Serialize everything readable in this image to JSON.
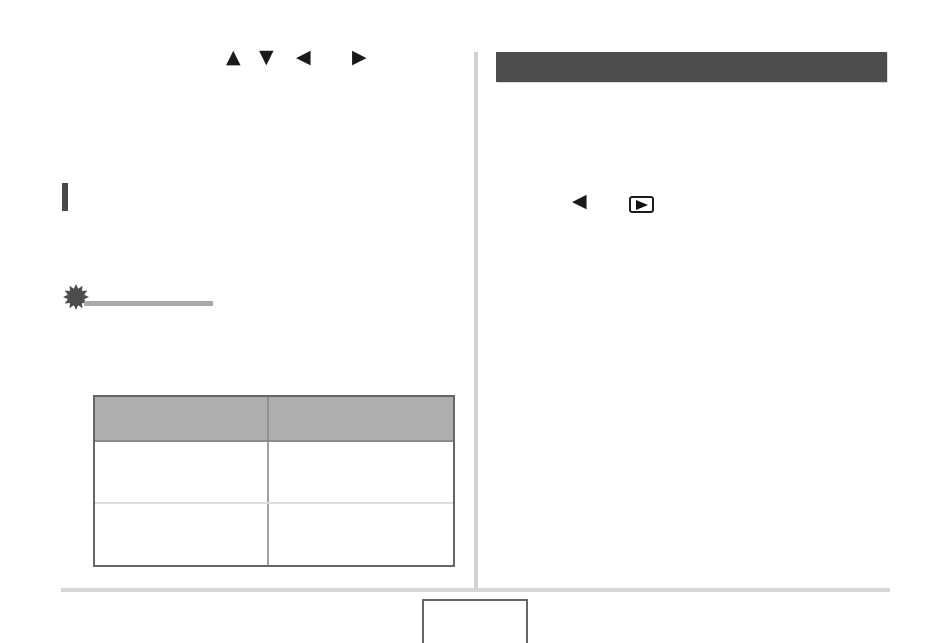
{
  "page": {
    "type": "camera-manual-page",
    "background": "#ffffff",
    "column_divider_color": "#d2d2d2"
  },
  "left_column": {
    "dpad_icons": {
      "up": "▲",
      "down": "▼",
      "left": "◀",
      "right": "▶",
      "color": "#1a1a1a"
    },
    "section_marker": {
      "color": "#4a4a4a"
    },
    "important_marker": {
      "icon": "starburst-icon",
      "icon_color": "#4d4d4d",
      "rule_color": "#a9a9a9"
    },
    "table": {
      "header_fill": "#aeaeae",
      "outer_border_color": "#666666",
      "header_divider_color": "#8a8a8a",
      "row_divider_color": "#dcdcdc",
      "column_divider_color": "#a2a2a2",
      "header": [
        "",
        ""
      ],
      "rows": [
        [
          "",
          ""
        ],
        [
          "",
          ""
        ]
      ]
    }
  },
  "right_column": {
    "header_bar": {
      "label": "",
      "fill": "#4d4d4d"
    },
    "nav_icons": {
      "left": "◀",
      "playback": "play-button-in-rounded-box",
      "color": "#1a1a1a"
    }
  },
  "footer": {
    "separator_color": "#d6d6d6",
    "page_number_box": {
      "value": "",
      "border_color": "#666666"
    }
  }
}
